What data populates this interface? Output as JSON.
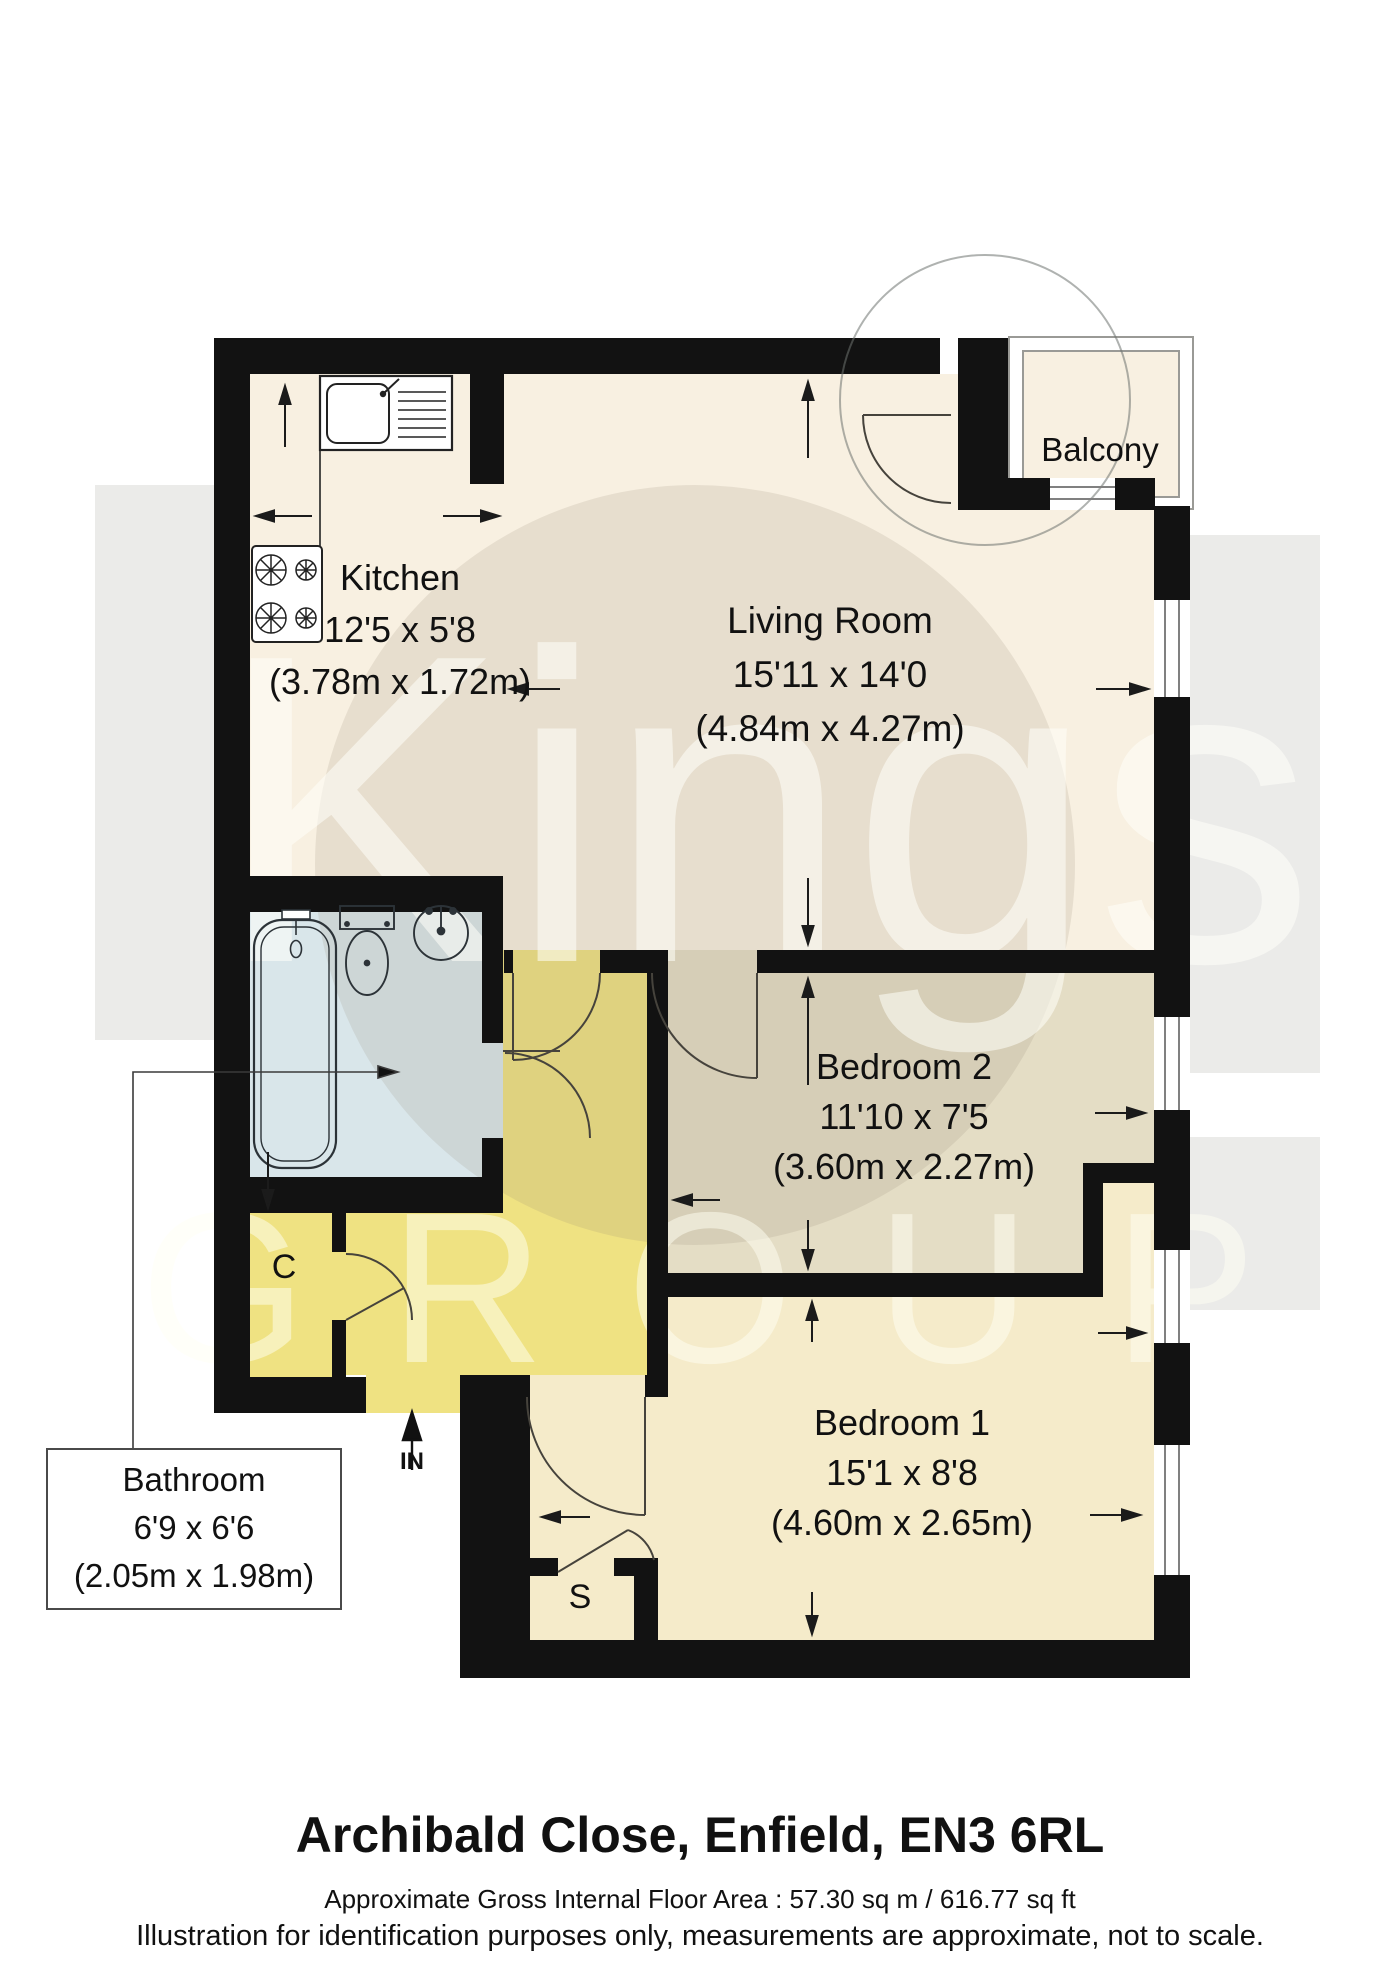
{
  "watermark": {
    "brand": "Kings",
    "brand_sub": "GROUP"
  },
  "rooms": {
    "kitchen": {
      "name": "Kitchen",
      "size_imperial": "12'5 x 5'8",
      "size_metric": "(3.78m x 1.72m)"
    },
    "living": {
      "name": "Living Room",
      "size_imperial": "15'11 x 14'0",
      "size_metric": "(4.84m x 4.27m)"
    },
    "balcony": {
      "name": "Balcony"
    },
    "bedroom2": {
      "name": "Bedroom 2",
      "size_imperial": "11'10 x 7'5",
      "size_metric": "(3.60m x 2.27m)"
    },
    "bedroom1": {
      "name": "Bedroom 1",
      "size_imperial": "15'1 x 8'8",
      "size_metric": "(4.60m x 2.65m)"
    },
    "bathroom": {
      "name": "Bathroom",
      "size_imperial": "6'9 x 6'6",
      "size_metric": "(2.05m x 1.98m)"
    },
    "closet": {
      "label": "C"
    },
    "store": {
      "label": "S"
    },
    "entrance": {
      "label": "IN"
    }
  },
  "footer": {
    "address": "Archibald Close, Enfield, EN3 6RL",
    "area": "Approximate Gross Internal Floor Area : 57.30 sq m / 616.77 sq ft",
    "disclaimer": "Illustration for identification purposes only, measurements are approximate, not to scale."
  },
  "colors": {
    "wall": "#121212",
    "floor_living_kitchen": "#f8f0e1",
    "floor_bedroom2": "#e4ddc5",
    "floor_bedroom1": "#f5ebca",
    "floor_hall": "#efe282",
    "floor_bathroom": "#d9e6ea",
    "watermark_band": "#ebebe9",
    "text": "#111111"
  }
}
